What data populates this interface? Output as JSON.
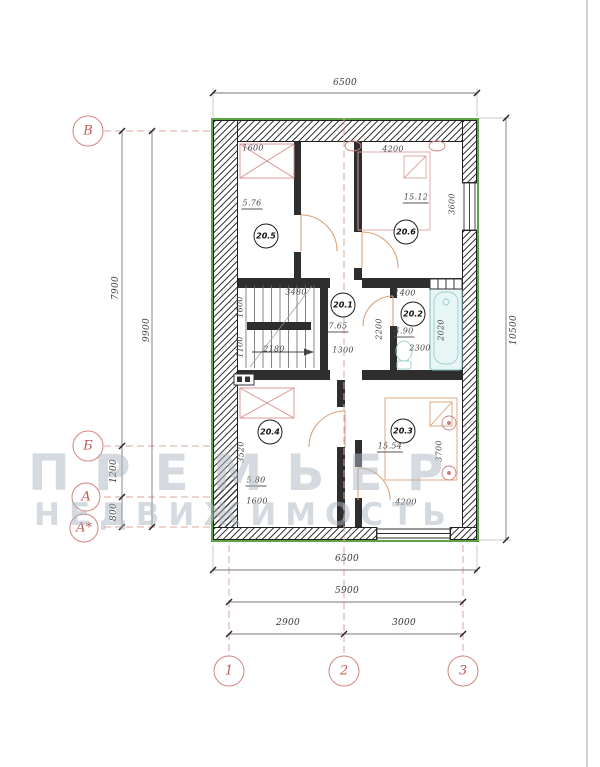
{
  "watermark": {
    "line1": "ПРЕМЬЕР",
    "line2": "НЕДВИЖИМОСТЬ"
  },
  "axes": {
    "left": [
      {
        "label": "В"
      },
      {
        "label": "Б"
      },
      {
        "label": "А"
      },
      {
        "label": "А*"
      }
    ],
    "bottom": [
      {
        "label": "1"
      },
      {
        "label": "2"
      },
      {
        "label": "3"
      }
    ]
  },
  "dims": {
    "top_width": "6500",
    "right_height": "10500",
    "left_total": "9900",
    "left_main": "7900",
    "left_seg_1200": "1200",
    "left_seg_800": "800",
    "bottom_width": "6500",
    "bottom_span": "5900",
    "bottom_left": "2900",
    "bottom_right": "3000"
  },
  "rooms": [
    {
      "number": "20.1",
      "area": "7.65"
    },
    {
      "number": "20.2",
      "area": "4.90"
    },
    {
      "number": "20.3",
      "area": "15.54"
    },
    {
      "number": "20.4",
      "area": "5.80"
    },
    {
      "number": "20.5",
      "area": "5.76"
    },
    {
      "number": "20.6",
      "area": "15.12"
    }
  ],
  "idims": {
    "r5_width": "1600",
    "r6_width": "4200",
    "r6_depth": "3600",
    "stair_hall": "3480",
    "bath_niche": "1400",
    "bath_depth": "2200",
    "bath_width": "2300",
    "bath_inner": "2020",
    "hall_width": "1300",
    "stair_run": "2180",
    "stair_f1": "1600",
    "stair_f2": "1100",
    "r4_depth": "3520",
    "r4_width": "1600",
    "r3_width": "4200",
    "r3_depth": "3700"
  },
  "colors": {
    "accent_red": "#c05a52",
    "outline_green": "#5ea345",
    "wall": "#2e2e2e",
    "furniture": "#dca276",
    "bath": "#7bbfc0",
    "watermark": "#aab6c0"
  }
}
